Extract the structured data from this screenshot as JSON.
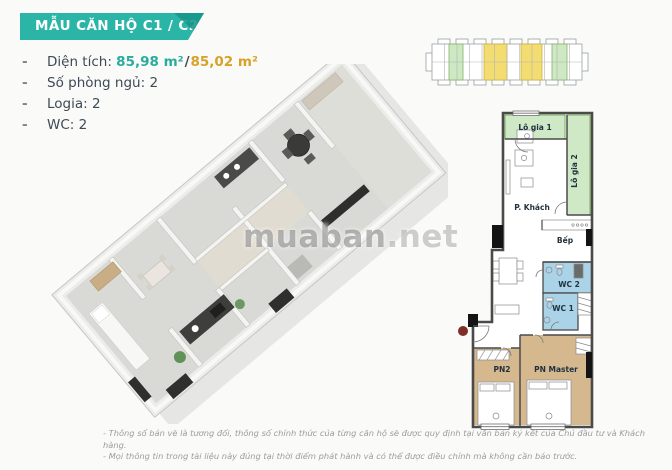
{
  "header": {
    "title": "MẪU CĂN HỘ C1 / C2"
  },
  "specs": {
    "bullet": "-",
    "area": {
      "label": "Diện tích:",
      "value_1": "85,98 m²",
      "separator": "/",
      "value_2": "85,02 m²"
    },
    "bedrooms": "Số phòng ngủ: 2",
    "logia": "Logia: 2",
    "wc": "WC: 2"
  },
  "key_plan": {
    "description": "building-floor-strip",
    "highlight_green": "#cde8c3",
    "highlight_yellow": "#f3dc72"
  },
  "floor_plan_2d": {
    "rooms": {
      "logia1": "Lô gia 1",
      "logia2": "Lô gia 2",
      "living": "P. Khách",
      "kitchen": "Bếp",
      "wc2": "WC 2",
      "wc1": "WC 1",
      "bedroom2": "PN2",
      "bedroom_master": "PN Master"
    },
    "colors": {
      "logia": "#cfe8c6",
      "wc": "#aad3e8",
      "bedroom": "#d6b88f",
      "wall": "#4a4a4a"
    }
  },
  "watermark": {
    "name": "muaban",
    "tld": ".net"
  },
  "footer": {
    "line1": "- Thông số bản vẽ là tương đối, thông số chính thức của từng căn hộ sẽ được quy định tại văn bản ký kết của Chủ đầu tư và Khách hàng.",
    "line2": "- Mọi thông tin trong tài liệu này đúng tại thời điểm phát hành và có thể được điều chỉnh mà không cần báo trước."
  },
  "colors": {
    "accent_teal": "#2bb5a6",
    "accent_teal_dark": "#159488",
    "accent_gold": "#d7a228",
    "text_dark": "#3e4a57",
    "text_gray": "#9c9c9c"
  }
}
